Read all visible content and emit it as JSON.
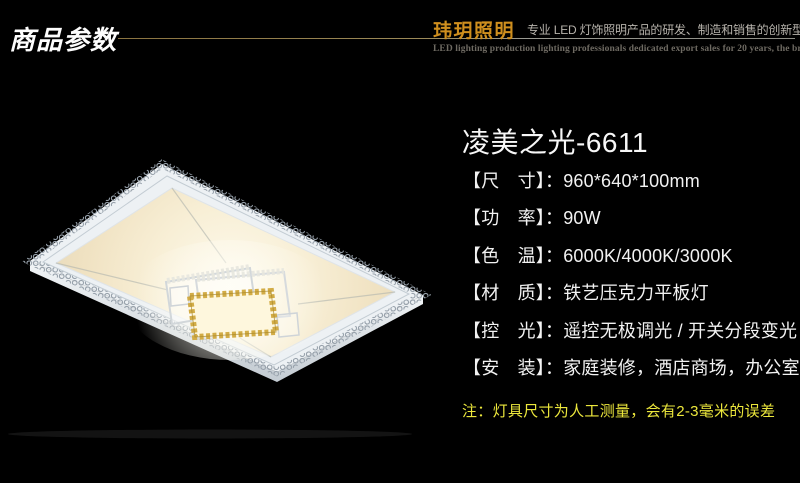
{
  "page": {
    "background": "#000000"
  },
  "header": {
    "section_title": "商品参数",
    "brand": "玮玥照明",
    "slogan": "专业 LED 灯饰照明产品的研发、制造和销售的创新型企业",
    "slogan_en": "LED lighting production lighting professionals dedicated export sales for 20 years, the brand manufacturers Direct",
    "brand_color": "#cf8f1e",
    "rule_line_color": "#8a7340"
  },
  "product": {
    "title": "凌美之光-6611",
    "specs": [
      {
        "name": "dimensions",
        "text": "【尺　寸】：960*640*100mm"
      },
      {
        "name": "power",
        "text": "【功　率】：90W"
      },
      {
        "name": "color-temperature",
        "text": "【色　温】：6000K/4000K/3000K"
      },
      {
        "name": "material",
        "text": "【材　质】：铁艺压克力平板灯"
      },
      {
        "name": "dimming",
        "text": "【控　光】：遥控无极调光 / 开关分段变光"
      },
      {
        "name": "installation",
        "text": "【安　装】：家庭装修，酒店商场，办公室等"
      }
    ],
    "note": "注：灯具尺寸为人工测量，会有2-3毫米的误差",
    "note_color": "#ece73c"
  },
  "image": {
    "subject": "rectangular-led-ceiling-lamp",
    "frame_color": "#edf1f4",
    "panel_glow_center": "#fdfaee",
    "panel_glow_edge": "#e6d9ba",
    "crystal_gold": "#d2ac46"
  }
}
